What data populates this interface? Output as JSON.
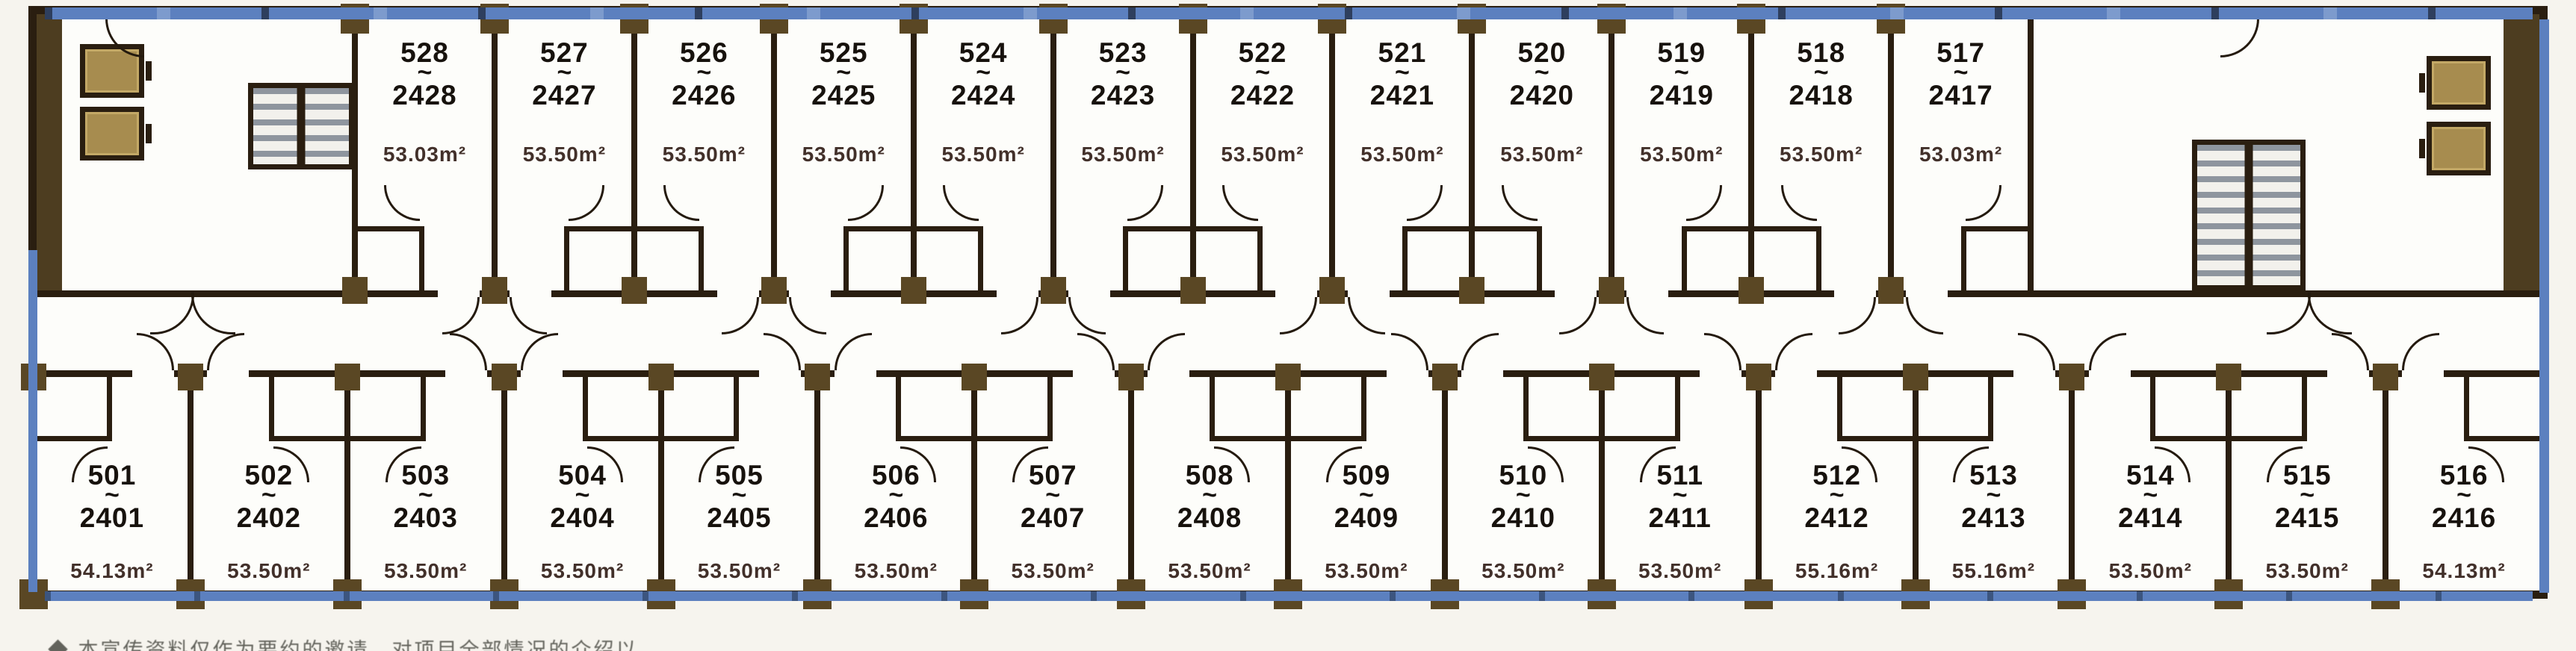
{
  "plan": {
    "label_separator": "~",
    "area_unit": "m²",
    "top_rooms": [
      {
        "no": "528",
        "alt": "2428",
        "area": "53.03m²"
      },
      {
        "no": "527",
        "alt": "2427",
        "area": "53.50m²"
      },
      {
        "no": "526",
        "alt": "2426",
        "area": "53.50m²"
      },
      {
        "no": "525",
        "alt": "2425",
        "area": "53.50m²"
      },
      {
        "no": "524",
        "alt": "2424",
        "area": "53.50m²"
      },
      {
        "no": "523",
        "alt": "2423",
        "area": "53.50m²"
      },
      {
        "no": "522",
        "alt": "2422",
        "area": "53.50m²"
      },
      {
        "no": "521",
        "alt": "2421",
        "area": "53.50m²"
      },
      {
        "no": "520",
        "alt": "2420",
        "area": "53.50m²"
      },
      {
        "no": "519",
        "alt": "2419",
        "area": "53.50m²"
      },
      {
        "no": "518",
        "alt": "2418",
        "area": "53.50m²"
      },
      {
        "no": "517",
        "alt": "2417",
        "area": "53.03m²"
      }
    ],
    "bottom_rooms": [
      {
        "no": "501",
        "alt": "2401",
        "area": "54.13m²"
      },
      {
        "no": "502",
        "alt": "2402",
        "area": "53.50m²"
      },
      {
        "no": "503",
        "alt": "2403",
        "area": "53.50m²"
      },
      {
        "no": "504",
        "alt": "2404",
        "area": "53.50m²"
      },
      {
        "no": "505",
        "alt": "2405",
        "area": "53.50m²"
      },
      {
        "no": "506",
        "alt": "2406",
        "area": "53.50m²"
      },
      {
        "no": "507",
        "alt": "2407",
        "area": "53.50m²"
      },
      {
        "no": "508",
        "alt": "2408",
        "area": "53.50m²"
      },
      {
        "no": "509",
        "alt": "2409",
        "area": "53.50m²"
      },
      {
        "no": "510",
        "alt": "2410",
        "area": "53.50m²"
      },
      {
        "no": "511",
        "alt": "2411",
        "area": "53.50m²"
      },
      {
        "no": "512",
        "alt": "2412",
        "area": "55.16m²"
      },
      {
        "no": "513",
        "alt": "2413",
        "area": "55.16m²"
      },
      {
        "no": "514",
        "alt": "2414",
        "area": "53.50m²"
      },
      {
        "no": "515",
        "alt": "2415",
        "area": "53.50m²"
      },
      {
        "no": "516",
        "alt": "2416",
        "area": "54.13m²"
      }
    ],
    "icons": {
      "stairs": "stairs-icon",
      "elevator": "elevator-icon",
      "door": "door-arc-icon"
    },
    "disclaimer": "◆ 本宣传资料仅作为要约的邀请，对项目全部情况的介绍以…",
    "colors": {
      "wall": "#2a1e10",
      "column": "#5a4724",
      "elevator": "#a78c4f",
      "glazing": "#5c80bf",
      "glazing_dark": "#2e3f5e",
      "area_text": "#42302a",
      "number_text": "#17120d",
      "paper": "#f6f4ee",
      "room_bg": "#fdfdfa"
    }
  }
}
